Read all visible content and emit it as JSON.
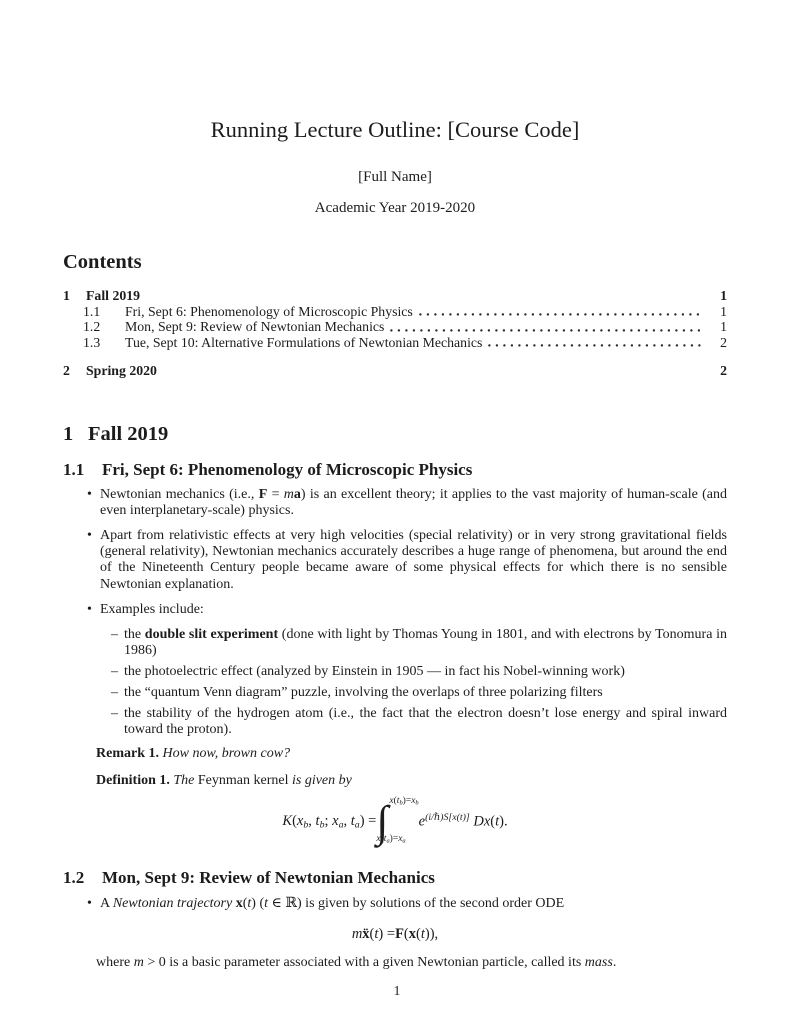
{
  "theme": {
    "ink": "#1c1c1c",
    "paper": "#ffffff"
  },
  "header": {
    "title": "Running Lecture Outline: [Course Code]",
    "author": "[Full Name]",
    "date": "Academic Year 2019-2020"
  },
  "contents": {
    "heading": "Contents",
    "entries": [
      {
        "number": "1",
        "label": "Fall 2019",
        "page": "1"
      },
      {
        "number": "1.1",
        "label": "Fri, Sept 6: Phenomenology of Microscopic Physics",
        "page": "1"
      },
      {
        "number": "1.2",
        "label": "Mon, Sept 9: Review of Newtonian Mechanics",
        "page": "1"
      },
      {
        "number": "1.3",
        "label": "Tue, Sept 10: Alternative Formulations of Newtonian Mechanics",
        "page": "2"
      },
      {
        "number": "2",
        "label": "Spring 2020",
        "page": "2"
      }
    ]
  },
  "markers": {
    "bullet": "•",
    "dash": "–"
  },
  "body": {
    "section1": {
      "number": "1",
      "title": "Fall 2019"
    },
    "sub11": {
      "number": "1.1",
      "title": "Fri, Sept 6: Phenomenology of Microscopic Physics"
    },
    "bullets11": {
      "b1": [
        {
          "t": "Newtonian mechanics (i.e., ",
          "s": ""
        },
        {
          "t": "F",
          "s": "b"
        },
        {
          "t": " = ",
          "s": ""
        },
        {
          "t": "m",
          "s": "i"
        },
        {
          "t": "a",
          "s": "b"
        },
        {
          "t": ") is an excellent theory; it applies to the vast majority of human-scale (and even interplanetary-scale) physics.",
          "s": ""
        }
      ],
      "b2": [
        {
          "t": "Apart from relativistic effects at very high velocities (special relativity) or in very strong gravitational fields (general relativity), Newtonian mechanics accurately describes a huge range of phenomena, but around the end of the Nineteenth Century people became aware of some physical effects for which there is no sensible Newtonian explanation.",
          "s": ""
        }
      ],
      "b3": [
        {
          "t": "Examples include:",
          "s": ""
        }
      ],
      "sub": {
        "s1": [
          {
            "t": "the ",
            "s": ""
          },
          {
            "t": "double slit experiment",
            "s": "b"
          },
          {
            "t": " (done with light by Thomas Young in 1801, and with electrons by Tonomura in 1986)",
            "s": ""
          }
        ],
        "s2": [
          {
            "t": "the photoelectric effect (analyzed by Einstein in 1905 — in fact his Nobel-winning work)",
            "s": ""
          }
        ],
        "s3": [
          {
            "t": "the “quantum Venn diagram” puzzle, involving the overlaps of three polarizing filters",
            "s": ""
          }
        ],
        "s4": [
          {
            "t": "the stability of the hydrogen atom (i.e., the fact that the electron doesn’t lose energy and spiral inward toward the proton).",
            "s": ""
          }
        ]
      }
    },
    "remark": [
      {
        "t": "Remark 1.",
        "s": "b"
      },
      {
        "t": " ",
        "s": ""
      },
      {
        "t": "How now, brown cow?",
        "s": "i"
      }
    ],
    "definition": [
      {
        "t": "Definition 1.",
        "s": "b"
      },
      {
        "t": " ",
        "s": ""
      },
      {
        "t": "The ",
        "s": "i"
      },
      {
        "t": "Feynman kernel",
        "s": ""
      },
      {
        "t": " is given by",
        "s": "i"
      }
    ],
    "kernel": {
      "lhs": [
        {
          "t": "K",
          "s": "i"
        },
        {
          "t": "(",
          "s": ""
        },
        {
          "t": "x",
          "s": "i"
        },
        {
          "t": "b",
          "s": "iu"
        },
        {
          "t": ", ",
          "s": ""
        },
        {
          "t": "t",
          "s": "i"
        },
        {
          "t": "b",
          "s": "iu"
        },
        {
          "t": "; ",
          "s": ""
        },
        {
          "t": "x",
          "s": "i"
        },
        {
          "t": "a",
          "s": "iu"
        },
        {
          "t": ", ",
          "s": ""
        },
        {
          "t": "t",
          "s": "i"
        },
        {
          "t": "a",
          "s": "iu"
        },
        {
          "t": ") = ",
          "s": ""
        }
      ],
      "int_sign": "∫",
      "upper": [
        {
          "t": "x",
          "s": "i"
        },
        {
          "t": "(",
          "s": ""
        },
        {
          "t": "t",
          "s": "i"
        },
        {
          "t": "b",
          "s": "iu"
        },
        {
          "t": ")=",
          "s": ""
        },
        {
          "t": "x",
          "s": "i"
        },
        {
          "t": "b",
          "s": "iu"
        }
      ],
      "lower": [
        {
          "t": "x",
          "s": "i"
        },
        {
          "t": "(",
          "s": ""
        },
        {
          "t": "t",
          "s": "i"
        },
        {
          "t": "a",
          "s": "iu"
        },
        {
          "t": ")=",
          "s": ""
        },
        {
          "t": "x",
          "s": "i"
        },
        {
          "t": "a",
          "s": "iu"
        }
      ],
      "rhs": [
        {
          "t": "e",
          "s": "i"
        },
        {
          "t": "(i/ℏ)S[x(t)]",
          "s": "ip"
        },
        {
          "t": " ",
          "s": ""
        },
        {
          "t": "D",
          "s": "i"
        },
        {
          "t": "x",
          "s": "i"
        },
        {
          "t": "(",
          "s": ""
        },
        {
          "t": "t",
          "s": "i"
        },
        {
          "t": ").",
          "s": ""
        }
      ]
    },
    "sub12": {
      "number": "1.2",
      "title": "Mon, Sept 9: Review of Newtonian Mechanics"
    },
    "bullets12": {
      "b1": [
        {
          "t": "A ",
          "s": ""
        },
        {
          "t": "Newtonian trajectory",
          "s": "i"
        },
        {
          "t": " ",
          "s": ""
        },
        {
          "t": "x",
          "s": "b"
        },
        {
          "t": "(",
          "s": ""
        },
        {
          "t": "t",
          "s": "i"
        },
        {
          "t": ") (",
          "s": ""
        },
        {
          "t": "t",
          "s": "i"
        },
        {
          "t": " ∈ ℝ) is given by solutions of the second order ODE",
          "s": ""
        }
      ]
    },
    "eq2": [
      {
        "t": "m",
        "s": "i"
      },
      {
        "t": " ",
        "s": ""
      },
      {
        "t": "ẍ",
        "s": "b"
      },
      {
        "t": "(",
        "s": ""
      },
      {
        "t": "t",
        "s": "i"
      },
      {
        "t": ") = ",
        "s": ""
      },
      {
        "t": "F",
        "s": "b"
      },
      {
        "t": "(",
        "s": ""
      },
      {
        "t": "x",
        "s": "b"
      },
      {
        "t": "(",
        "s": ""
      },
      {
        "t": "t",
        "s": "i"
      },
      {
        "t": ")),",
        "s": ""
      }
    ],
    "where": [
      {
        "t": "where ",
        "s": ""
      },
      {
        "t": "m",
        "s": "i"
      },
      {
        "t": " > 0 is a basic parameter associated with a given Newtonian particle, called its ",
        "s": ""
      },
      {
        "t": "mass",
        "s": "i"
      },
      {
        "t": ".",
        "s": ""
      }
    ]
  },
  "footer": {
    "page_number": "1"
  }
}
